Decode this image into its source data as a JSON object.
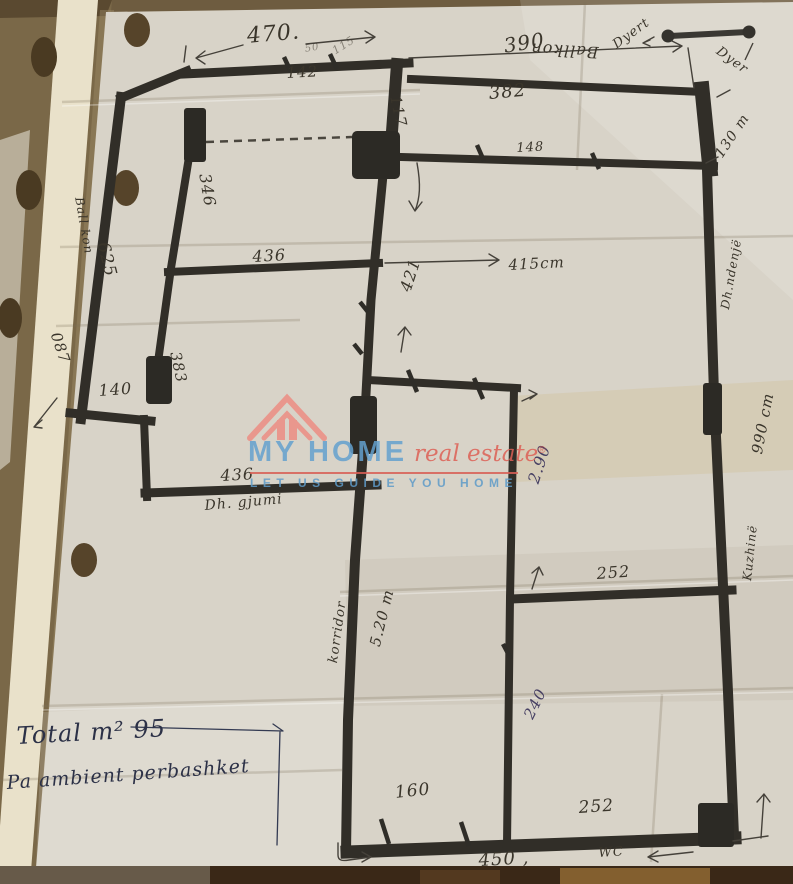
{
  "logo": {
    "brand": "MY HOME",
    "suffix": "real estate",
    "registered": "®",
    "tagline": "LET US GUIDE YOU HOME"
  },
  "summary": {
    "line1": "Total m² 95",
    "line2": "Pa ambient perbashket"
  },
  "legend": {
    "door_symbol_left": "Dyert",
    "door_symbol_right": "Dyer"
  },
  "rooms": {
    "balcony_top": "Ballkon",
    "balcony_left": "Ball kon",
    "bedroom": "Dh. gjumi",
    "living": "Dh.ndenjë",
    "kitchen": "Kuzhinë",
    "corridor": "korridor",
    "wc": "WC"
  },
  "dimensions": {
    "top": "470.",
    "top_seg": "142",
    "top_small_a": "50",
    "top_small_b": "115",
    "balcony_width": "390",
    "balcony_inner": "382",
    "balcony_wall": "148",
    "stub": "117",
    "balcony_height": "130 m",
    "left_corridor": "625",
    "left_top_room": "346",
    "left_small": "087",
    "small_room": "140",
    "left_pillar": "383",
    "bedroom_top": "436",
    "bedroom_bottom": "436",
    "center_height": "421",
    "living_width": "415cm",
    "kitchen_height": "2.90",
    "kitchen_top": "252",
    "right_height": "990 cm",
    "corridor_len": "5.20 m",
    "wc_height": "240",
    "bath_width": "160",
    "wc_width": "252",
    "bottom": "450 ,"
  }
}
